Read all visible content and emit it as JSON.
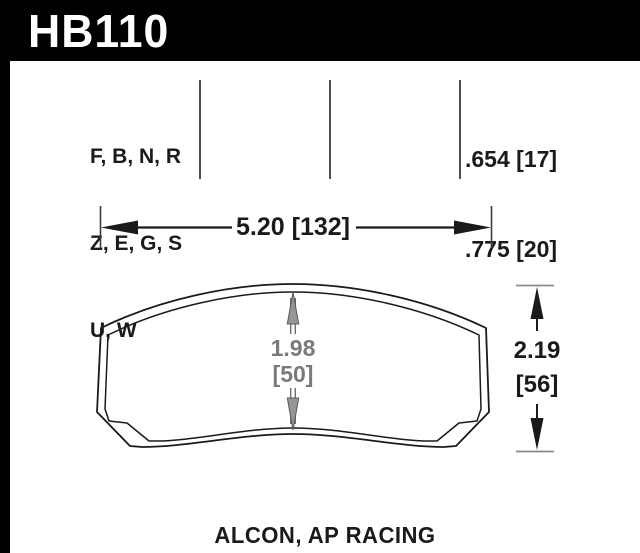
{
  "header": {
    "part_number": "HB110"
  },
  "compound_codes": {
    "lines": [
      "F, B, N, R",
      "Z, E, G, S",
      "U, W"
    ]
  },
  "pad_thickness": {
    "values": [
      ".654 [17]",
      ".775 [20]"
    ]
  },
  "dimensions": {
    "width_label": "5.20 [132]",
    "center_height": {
      "value": "1.98",
      "metric": "[50]"
    },
    "overall_height": {
      "value": "2.19",
      "metric": "[56]"
    }
  },
  "footer": {
    "applications": "ALCON, AP RACING"
  },
  "colors": {
    "header_bg": "#000000",
    "header_text": "#ffffff",
    "ink": "#1a1a1a",
    "dim_gray_text": "#7a7a7a",
    "arrow_gray_fill": "#969696",
    "tick_gray": "#8a8a8a"
  }
}
